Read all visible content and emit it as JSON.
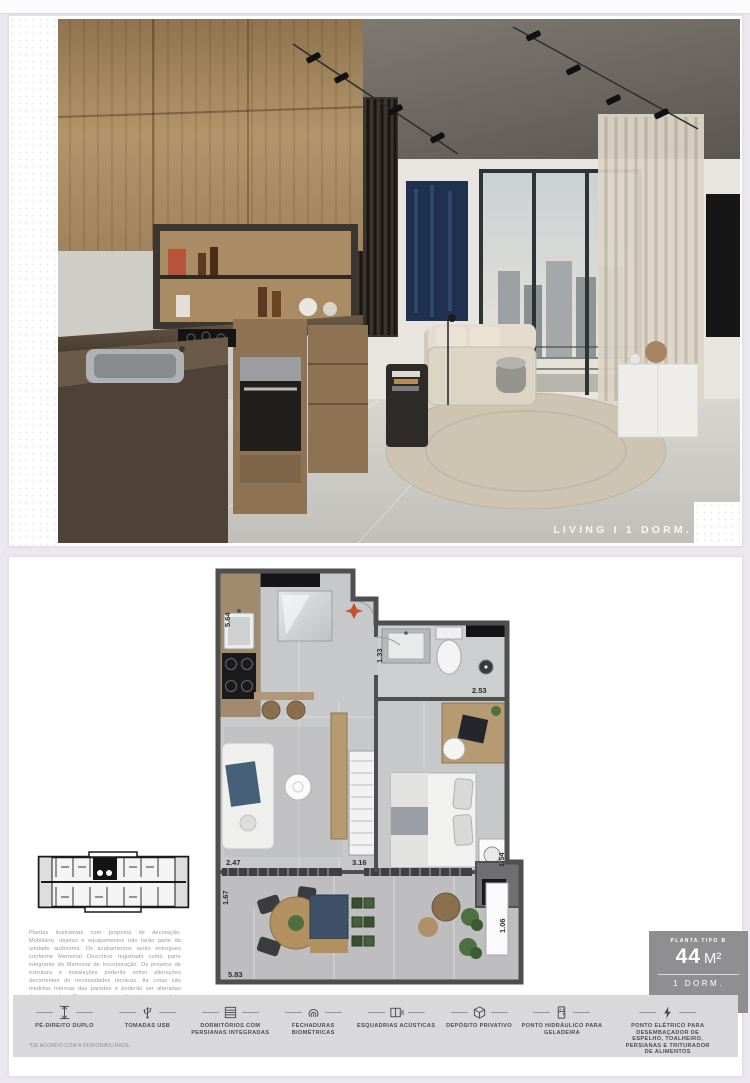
{
  "photo": {
    "caption": "LIVING I 1 DORM."
  },
  "plan": {
    "dimensions": {
      "kitchen_wall": "5.64",
      "bath_wall": "1.33",
      "bedroom_width": "2.53",
      "living_width": "2.47",
      "bedroom_depth": "3.16",
      "service_niche": "1.54",
      "balcony_depth": "1.67",
      "balcony_width": "5.83",
      "balcony_end": "1.06"
    },
    "north_arrow_color": "#c2512d"
  },
  "badge": {
    "type_label": "PLANTA TIPO B",
    "area_value": "44",
    "area_unit": "M²",
    "dorm_label": "1 DORM.",
    "floors_label": "DO 8º AO 17º PAVIMENTO"
  },
  "disclaimer": "Plantas ilustrativas com proposta de decoração. Mobiliário, objetos e equipamentos não farão parte da unidade autônoma. Os acabamentos serão entregues conforme Memorial Descritivo registrado como parte integrante do Memorial de Incorporação. Os projetos de estrutura e instalações poderão sofrer alterações decorrentes de necessidades técnicas. As cotas são medidas internas das paredes e poderão ser alteradas durante a obra. O piso e o teto serão entregues na laje. Poderá haver modificação de posicionamento de unidade na torre conforme pavimento escolhido.",
  "footnote": "*DE ACORDO COM A DISPONIBILIDADE.",
  "amenities": {
    "items": [
      {
        "icon": "double-height-icon",
        "label": "PÉ-DIREITO DUPLO"
      },
      {
        "icon": "usb-outlet-icon",
        "label": "TOMADAS USB"
      },
      {
        "icon": "integrated-blinds-icon",
        "label": "DORMITÓRIOS COM PERSIANAS INTEGRADAS"
      },
      {
        "icon": "biometric-lock-icon",
        "label": "FECHADURAS BIOMÉTRICAS"
      },
      {
        "icon": "acoustic-window-icon",
        "label": "ESQUADRIAS ACÚSTICAS"
      },
      {
        "icon": "private-storage-icon",
        "label": "DEPÓSITO PRIVATIVO"
      },
      {
        "icon": "refrigerator-water-point-icon",
        "label": "PONTO HIDRÁULICO PARA GELADEIRA"
      },
      {
        "icon": "electric-point-icon",
        "label": "PONTO ELÉTRICO PARA DESEMBAÇADOR DE ESPELHO, TOALHEIRO, PERSIANAS E TRITURADOR DE ALIMENTOS"
      }
    ]
  },
  "colors": {
    "accent_orange": "#c2512d",
    "badge_gray": "#8f8f91",
    "wall_gray": "#4f4f52",
    "wood": "#b59a72",
    "navy_upholstery": "#3d5168",
    "strip_bg": "#d9d9dc"
  }
}
